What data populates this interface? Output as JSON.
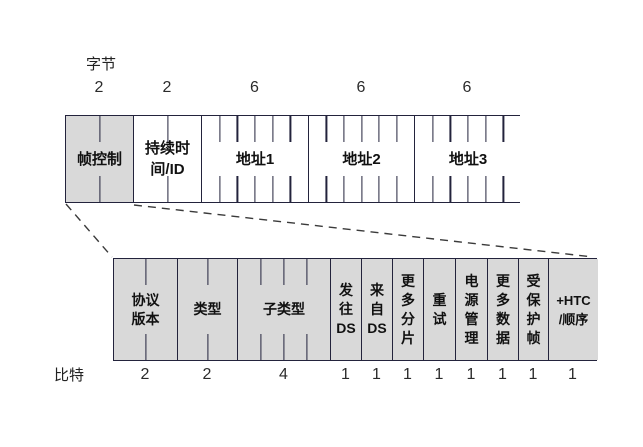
{
  "figure": {
    "top_scale_label": "字节",
    "bottom_scale_label": "比特",
    "colors": {
      "shaded_cell": "#d9d9d9",
      "plain_cell": "#ffffff",
      "border": "#23233c",
      "text": "#111111"
    },
    "byte_fields": [
      {
        "label": "帧控制",
        "lines": [
          "帧控制"
        ],
        "units": 2,
        "count_label": "2",
        "shaded": true,
        "width_px": 68
      },
      {
        "label": "持续时间/ID",
        "lines": [
          "持续时",
          "间/ID"
        ],
        "units": 2,
        "count_label": "2",
        "shaded": false,
        "width_px": 68
      },
      {
        "label": "地址1",
        "lines": [
          "地址1"
        ],
        "units": 6,
        "count_label": "6",
        "shaded": false,
        "width_px": 107
      },
      {
        "label": "地址2",
        "lines": [
          "地址2"
        ],
        "units": 6,
        "count_label": "6",
        "shaded": false,
        "width_px": 106
      },
      {
        "label": "地址3",
        "lines": [
          "地址3"
        ],
        "units": 6,
        "count_label": "6",
        "shaded": false,
        "width_px": 106
      }
    ],
    "bit_fields": [
      {
        "label": "协议版本",
        "lines": [
          "协议",
          "版本"
        ],
        "units": 2,
        "count_label": "2",
        "shaded": true,
        "width_px": 64
      },
      {
        "label": "类型",
        "lines": [
          "类型"
        ],
        "units": 2,
        "count_label": "2",
        "shaded": true,
        "width_px": 60
      },
      {
        "label": "子类型",
        "lines": [
          "子类型"
        ],
        "units": 4,
        "count_label": "4",
        "shaded": true,
        "width_px": 93
      },
      {
        "label": "发往DS",
        "lines": [
          "发",
          "往",
          "DS"
        ],
        "units": 1,
        "count_label": "1",
        "shaded": true,
        "width_px": 31
      },
      {
        "label": "来自DS",
        "lines": [
          "来",
          "自",
          "DS"
        ],
        "units": 1,
        "count_label": "1",
        "shaded": true,
        "width_px": 31
      },
      {
        "label": "更多分片",
        "lines": [
          "更",
          "多",
          "分",
          "片"
        ],
        "units": 1,
        "count_label": "1",
        "shaded": true,
        "width_px": 31
      },
      {
        "label": "重试",
        "lines": [
          "重",
          "试"
        ],
        "units": 1,
        "count_label": "1",
        "shaded": true,
        "width_px": 32
      },
      {
        "label": "电源管理",
        "lines": [
          "电",
          "源",
          "管",
          "理"
        ],
        "units": 1,
        "count_label": "1",
        "shaded": true,
        "width_px": 32
      },
      {
        "label": "更多数据",
        "lines": [
          "更",
          "多",
          "数",
          "据"
        ],
        "units": 1,
        "count_label": "1",
        "shaded": true,
        "width_px": 31
      },
      {
        "label": "受保护帧",
        "lines": [
          "受",
          "保",
          "护",
          "帧"
        ],
        "units": 1,
        "count_label": "1",
        "shaded": true,
        "width_px": 30
      },
      {
        "label": "+HTC/顺序",
        "lines": [
          "+HTC",
          "/顺序"
        ],
        "units": 1,
        "count_label": "1",
        "shaded": true,
        "width_px": 49
      }
    ]
  }
}
